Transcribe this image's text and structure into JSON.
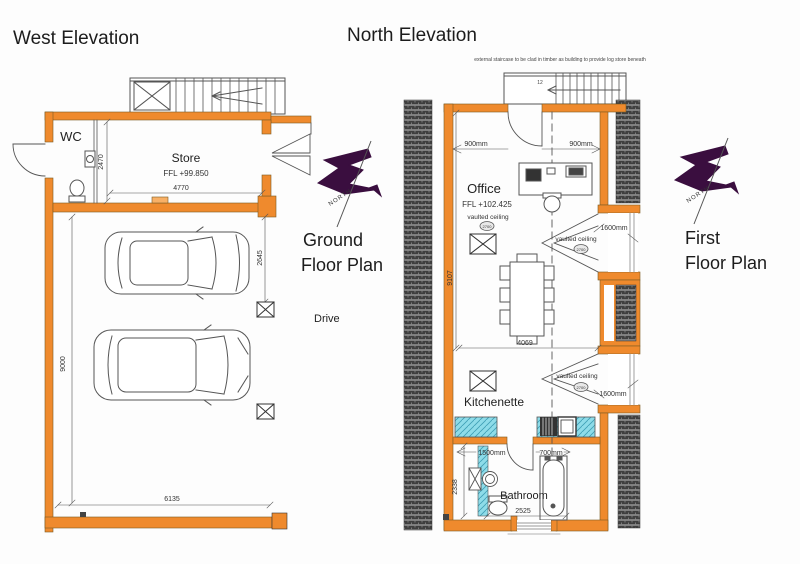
{
  "colors": {
    "wall_orange": "#EF8A2D",
    "counter_cyan": "#8EDCE9",
    "north_purple": "#3A0E3F",
    "hatch_dark": "#3F3F3F",
    "line_gray": "#555555"
  },
  "titles": {
    "west_elevation": "West Elevation",
    "north_elevation": "North Elevation"
  },
  "compass": {
    "north": "NORTH"
  },
  "ground_floor": {
    "plan_label_1": "Ground",
    "plan_label_2": "Floor Plan",
    "drive": "Drive",
    "rooms": {
      "wc": "WC",
      "store": "Store"
    },
    "store_ffl": "FFL +99.850",
    "dims": {
      "store_width": "4770",
      "store_depth": "2470",
      "bay_depth": "2645",
      "plan_length": "9000",
      "plan_width": "6135"
    }
  },
  "first_floor": {
    "plan_label_1": "First",
    "plan_label_2": "Floor Plan",
    "note": "external staircase to be clad in timber as building to provide log store beneath",
    "stair_steps": "12",
    "rooms": {
      "office": "Office",
      "kitchenette": "Kitchenette",
      "bathroom": "Bathroom"
    },
    "office_ffl": "FFL +102.425",
    "vaulted_ceiling": "vaulted ceiling",
    "ceiling_height": "2700",
    "dims": {
      "door_left": "900mm",
      "door_right": "900mm",
      "dormer": "1600mm",
      "table_width": "4069",
      "room_length": "9107",
      "bath_door": "1500mm",
      "bath_width": "700mm",
      "bathroom_width": "2525",
      "bathroom_depth": "2338"
    }
  }
}
